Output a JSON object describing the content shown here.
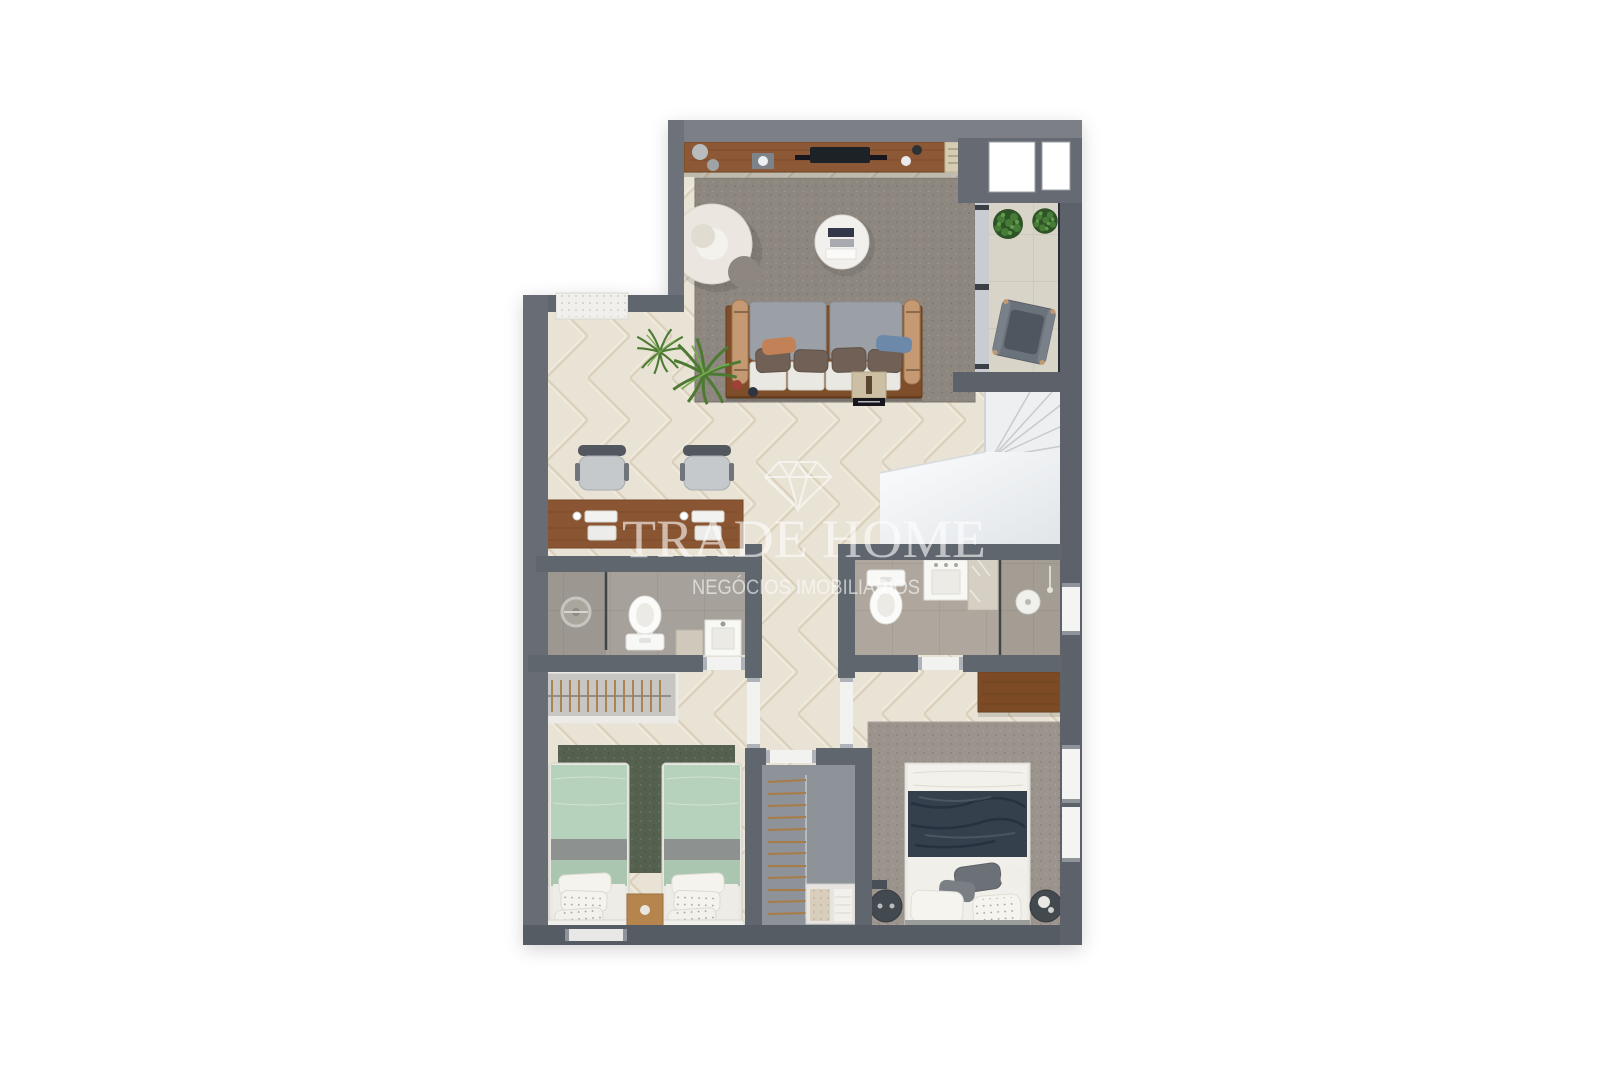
{
  "watermark": {
    "title": "TRADE HOME",
    "subtitle": "NEGÓCIOS IMOBILIÁRIOS",
    "icon": "diamond-outline-icon",
    "text_color": "#ffffff",
    "opacity": "0.6"
  },
  "palette": {
    "background": "#ffffff",
    "wall": "#61666e",
    "wall_top": "#7b8086",
    "wall_dark": "#575c64",
    "wood_floor": "#e9e3d5",
    "wood_floor_line": "#d9cfba",
    "wood_furniture": "#8a5632",
    "living_rug": "#8d8780",
    "master_rug": "#9a948c",
    "twin_rug_green": "#54614f",
    "bed_mint": "#b6d1bc",
    "bed_navy": "#343f4d",
    "sofa_gray": "#9aa0a6",
    "stairs_white": "#eff1f3",
    "bath_tile": "#a6a19a",
    "balcony_tile": "#d8d4c8",
    "balcony_glass": "#2b2f34",
    "plant_green": "#4d7a33",
    "fixture_white": "#f8f8f6"
  }
}
